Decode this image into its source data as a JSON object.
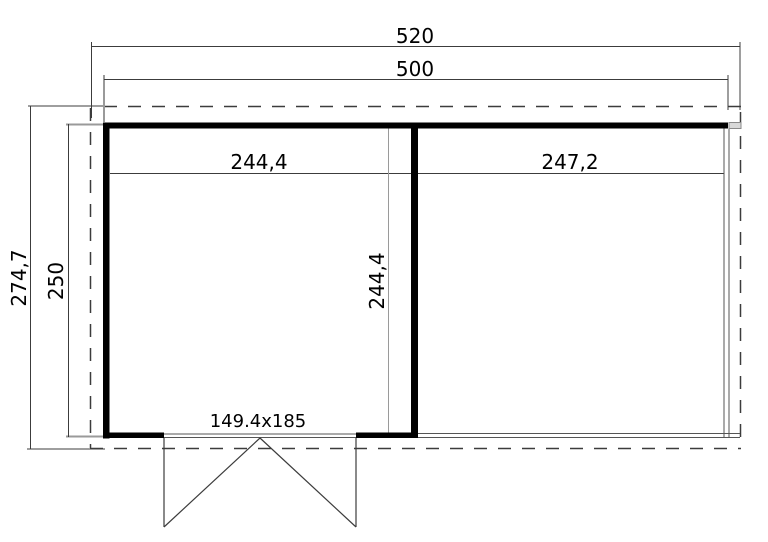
{
  "drawing": {
    "type": "floor-plan",
    "dimensions": {
      "overall_width": "520",
      "wall_width": "500",
      "overall_depth": "274,7",
      "wall_depth": "250",
      "left_room_width": "244,4",
      "right_room_width": "247,2",
      "left_room_depth": "244,4",
      "door_size": "149.4x185"
    },
    "colors": {
      "wall": "#000000",
      "dimension_line": "#3c3c3c",
      "extension_line": "#9a9a9a",
      "thin_edge": "#555555",
      "background": "#ffffff"
    }
  }
}
